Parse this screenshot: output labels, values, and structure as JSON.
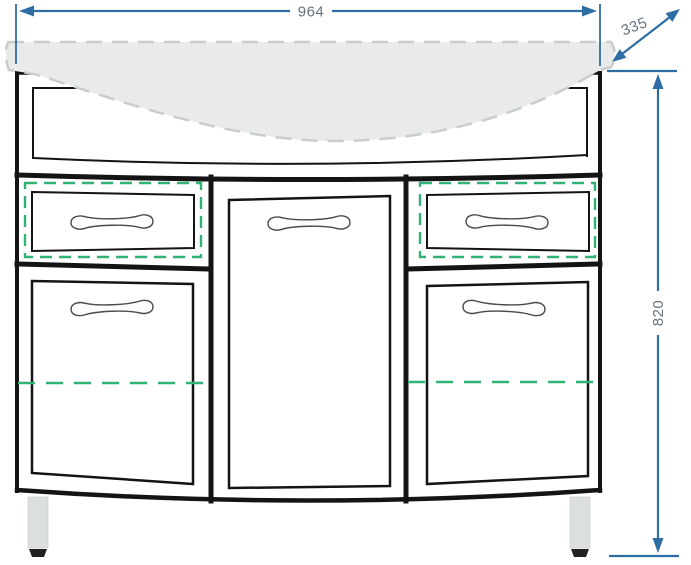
{
  "drawing": {
    "kind": "furniture-elevation",
    "dimensions": {
      "width_label": "964",
      "depth_label": "335",
      "height_label": "820"
    },
    "colors": {
      "dimension_line": "#2e6da4",
      "dimension_text": "#66727e",
      "cabinet_outline": "#141414",
      "hidden_feature_green": "#31b473",
      "countertop_fill": "#e9ebea",
      "countertop_stroke": "#c9cdcc",
      "leg_fill": "#dcdfdf",
      "foot_fill": "#222222"
    }
  }
}
